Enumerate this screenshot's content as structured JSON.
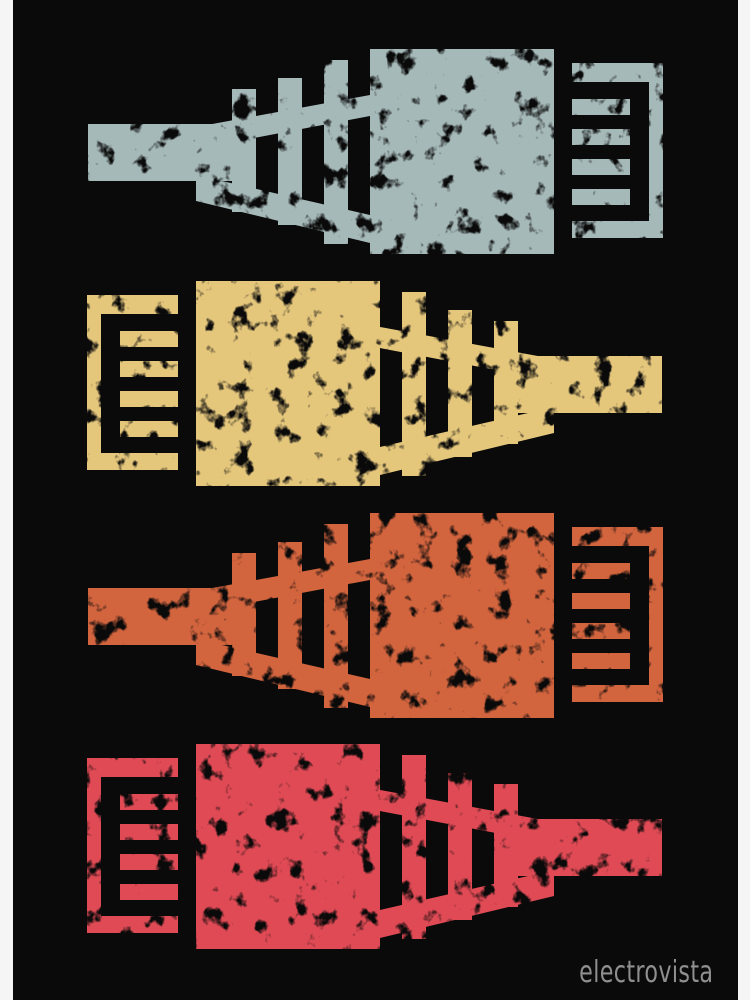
{
  "canvas": {
    "page_background": "#f5f5f6",
    "art_background": "#0a0a0a",
    "art_left_edge": 13,
    "art_width": 725
  },
  "connectors": [
    {
      "id": "ethernet-plug-1",
      "color_name": "slate-blue",
      "color": "#a6b9b9",
      "direction": "right",
      "x": 75,
      "y": 49
    },
    {
      "id": "ethernet-plug-2",
      "color_name": "mustard-yellow",
      "color": "#e5c77c",
      "direction": "left",
      "x": 74,
      "y": 281
    },
    {
      "id": "ethernet-plug-3",
      "color_name": "burnt-orange",
      "color": "#d2643e",
      "direction": "right",
      "x": 75,
      "y": 513
    },
    {
      "id": "ethernet-plug-4",
      "color_name": "crimson-red",
      "color": "#e04a55",
      "direction": "left",
      "x": 74,
      "y": 744
    }
  ],
  "watermark": {
    "text": "electrovista",
    "color": "#8f8f8f"
  }
}
